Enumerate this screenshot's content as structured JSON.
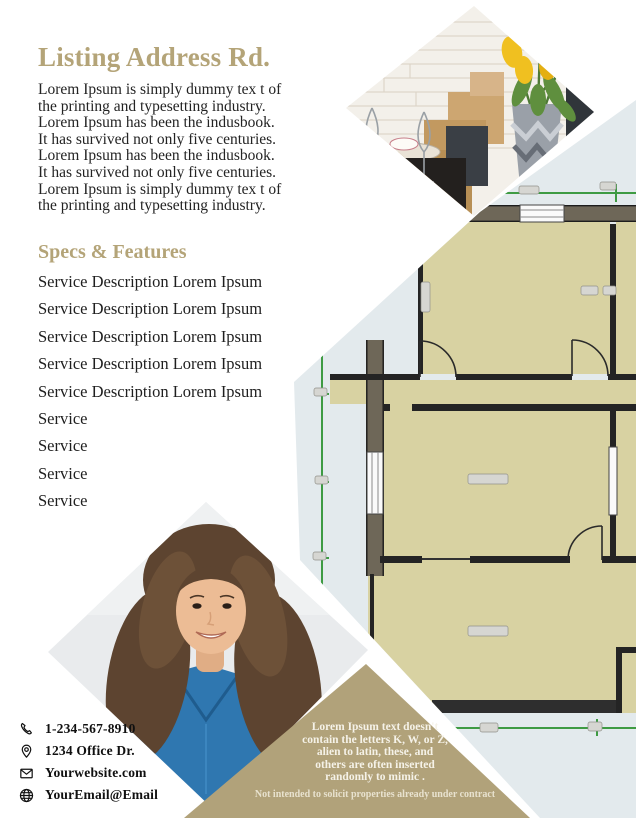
{
  "title": "Listing Address Rd.",
  "intro": "Lorem Ipsum is simply dummy tex t of\nthe printing and typesetting industry.\nLorem Ipsum has been the indusbook.\nIt has survived not only five centuries.\nLorem Ipsum has been the indusbook.\nIt has survived not only five centuries.\nLorem Ipsum is simply dummy tex t of\nthe printing and typesetting industry.",
  "specs_heading": "Specs & Features",
  "services": [
    "Service Description Lorem Ipsum",
    "Service Description Lorem Ipsum",
    "Service Description Lorem Ipsum",
    "Service Description Lorem Ipsum",
    "Service Description Lorem Ipsum",
    "Service",
    "Service",
    "Service",
    "Service"
  ],
  "contact": {
    "phone": "1-234-567-8910",
    "address": "1234 Office Dr.",
    "website": "Yourwebsite.com",
    "email": "YourEmail@Email"
  },
  "icons": {
    "phone": "phone-icon",
    "address": "location-pin-icon",
    "website": "envelope-icon",
    "email": "globe-icon"
  },
  "callout": {
    "text": "Lorem Ipsum text doesn't\ncontain the letters K, W, or Z,\nalien to latin, these, and\nothers are often inserted\nrandomly to mimic .",
    "disclaimer": "Not intended to solicit properties already under contract"
  },
  "images": {
    "top_photo": "kitchen-dining-with-yellow-tulips",
    "bottom_photo": "agent-portrait-blue-shirt",
    "plan": "floor-plan"
  },
  "colors": {
    "gold": "#b4a478",
    "ink": "#232323",
    "tan": "#b1a27a",
    "khaki": "#d8d2a2",
    "planbg": "#e3eaed",
    "olive": "#6e6758",
    "wall": "#242424",
    "green": "#3e9b43",
    "photobg": "#e9ebed"
  }
}
